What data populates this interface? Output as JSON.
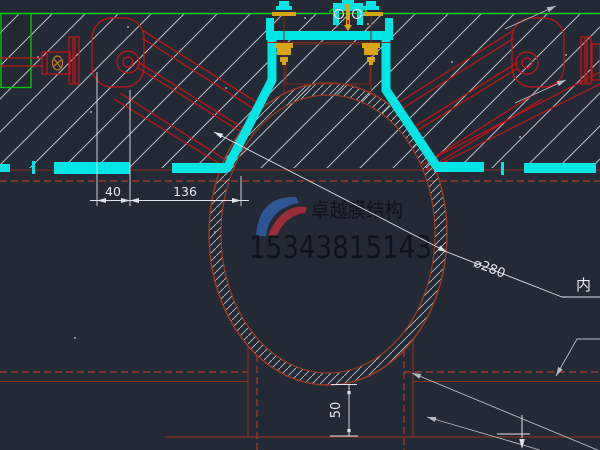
{
  "drawing": {
    "type": "cad-section-detail",
    "dimensions": {
      "dim_40": "40",
      "dim_136": "136",
      "dim_50": "50",
      "dim_diameter": "⌀280"
    },
    "labels": {
      "leader_right_partial": "内"
    },
    "watermark": {
      "company": "卓越膜结构",
      "phone": "15343815143"
    },
    "colors": {
      "background": "#242936",
      "membrane_cyan": "#00e6e6",
      "line_green": "#00c800",
      "steel_red": "#c41414",
      "hidden_dark_red": "#8a2f1e",
      "dashed_red": "#ad3a28",
      "bolt_gold": "#d8a516",
      "dimension_white": "#e6e9ee",
      "leader_gray": "#b5bac3",
      "watermark_text": "#0e1219",
      "logo_blue": "#2e5b9e",
      "logo_red": "#a82d38"
    }
  }
}
